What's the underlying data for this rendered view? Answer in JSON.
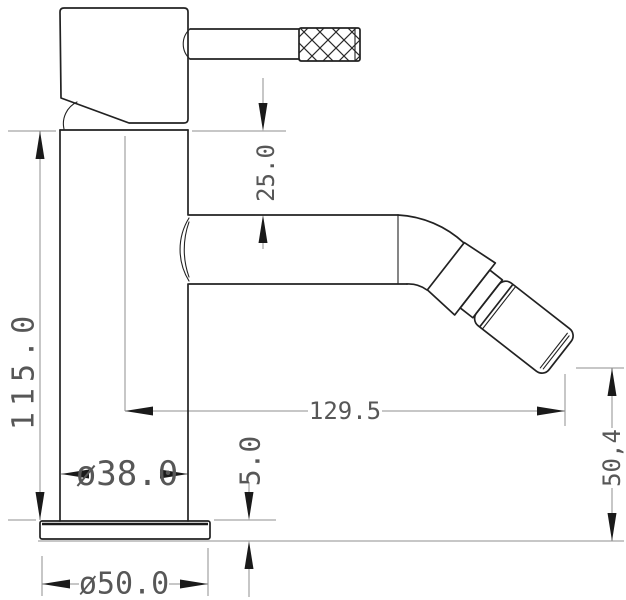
{
  "drawing": {
    "background_color": "#ffffff",
    "object_line_color": "#222222",
    "thin_line_color": "#8f8f8f",
    "label_color": "#575757",
    "dimensions": {
      "handle_to_spout_height": "25.0",
      "body_height": "115.0",
      "spout_reach": "129.5",
      "body_diameter": "ø38.0",
      "base_thickness": "5.0",
      "outlet_height": "50,4",
      "base_diameter": "ø50.0"
    }
  }
}
